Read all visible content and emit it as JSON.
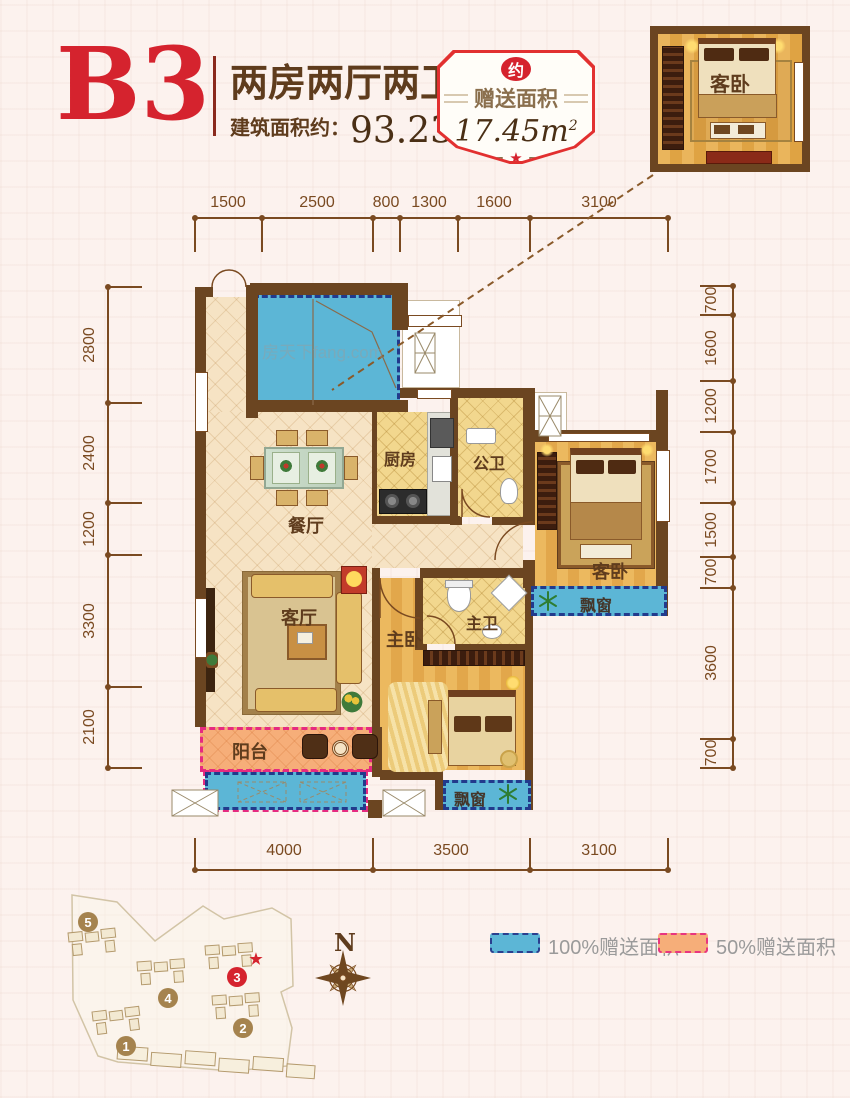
{
  "header": {
    "plan_code": "B3",
    "layout_title": "两房两厅两卫",
    "area_label": "建筑面积约：",
    "area_value": "93.23m",
    "area_sup": "2"
  },
  "badge": {
    "tag": "约",
    "title": "赠送面积",
    "value": "17.45m",
    "sup": "2",
    "star": "★"
  },
  "inset": {
    "room_label": "客卧"
  },
  "watermark": "房天下fang.com",
  "dims": {
    "top": [
      "1500",
      "2500",
      "800",
      "1300",
      "1600",
      "3100"
    ],
    "bottom": [
      "4000",
      "3500",
      "3100"
    ],
    "left": [
      "2800",
      "2400",
      "1200",
      "3300",
      "2100"
    ],
    "right": [
      "700",
      "1600",
      "1200",
      "1700",
      "1500",
      "700",
      "3600",
      "700"
    ]
  },
  "rooms": {
    "dining": "餐厅",
    "kitchen": "厨房",
    "public_bath": "公卫",
    "guest_bedroom": "客卧",
    "guest_bay_window": "飘窗",
    "living": "客厅",
    "master_bedroom": "主卧",
    "master_bath": "主卫",
    "balcony": "阳台",
    "master_bay_window": "飘窗"
  },
  "legend": {
    "items": [
      {
        "label": "100%赠送面积",
        "swatch": "#5cb6d6",
        "border": "#223a8c"
      },
      {
        "label": "50%赠送面积",
        "swatch": "#f6ae79",
        "border": "#e62a80"
      }
    ]
  },
  "compass": {
    "label": "N"
  },
  "site": {
    "buildings": [
      "1",
      "2",
      "3",
      "4",
      "5"
    ],
    "highlighted": "3",
    "marker": "★"
  },
  "colors": {
    "accent_red": "#d5232e",
    "wall_brown": "#6b4521",
    "dim_brown": "#7a4a21",
    "text_brown": "#5f3c1d",
    "gift_blue": "#5cb6d6",
    "gift_blue_border": "#223a8c",
    "gift_orange": "#f6ae79",
    "gift_orange_border": "#e62a80"
  }
}
